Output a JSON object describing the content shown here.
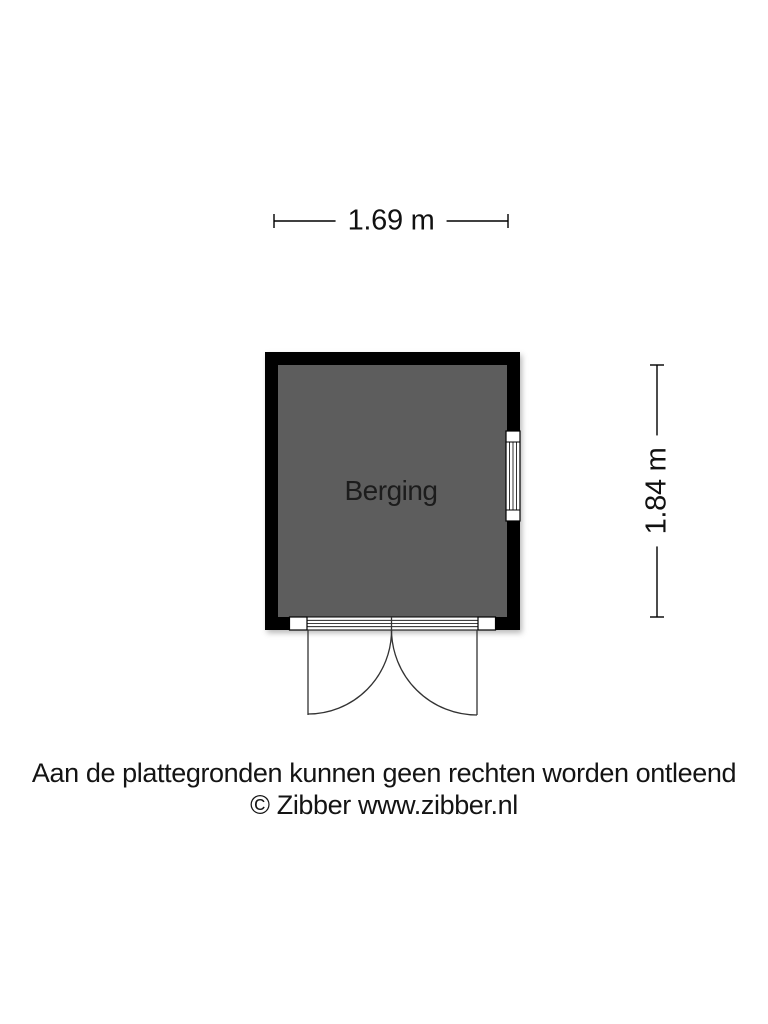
{
  "floorplan": {
    "room": {
      "label": "Berging"
    },
    "dimensions": {
      "width_label": "1.69 m",
      "height_label": "1.84 m"
    },
    "colors": {
      "wall": "#000000",
      "floor": "#5d5d5d",
      "line": "#000000",
      "background": "#ffffff"
    }
  },
  "footer": {
    "disclaimer": "Aan de plattegronden kunnen geen rechten worden ontleend",
    "copyright": "© Zibber www.zibber.nl"
  }
}
